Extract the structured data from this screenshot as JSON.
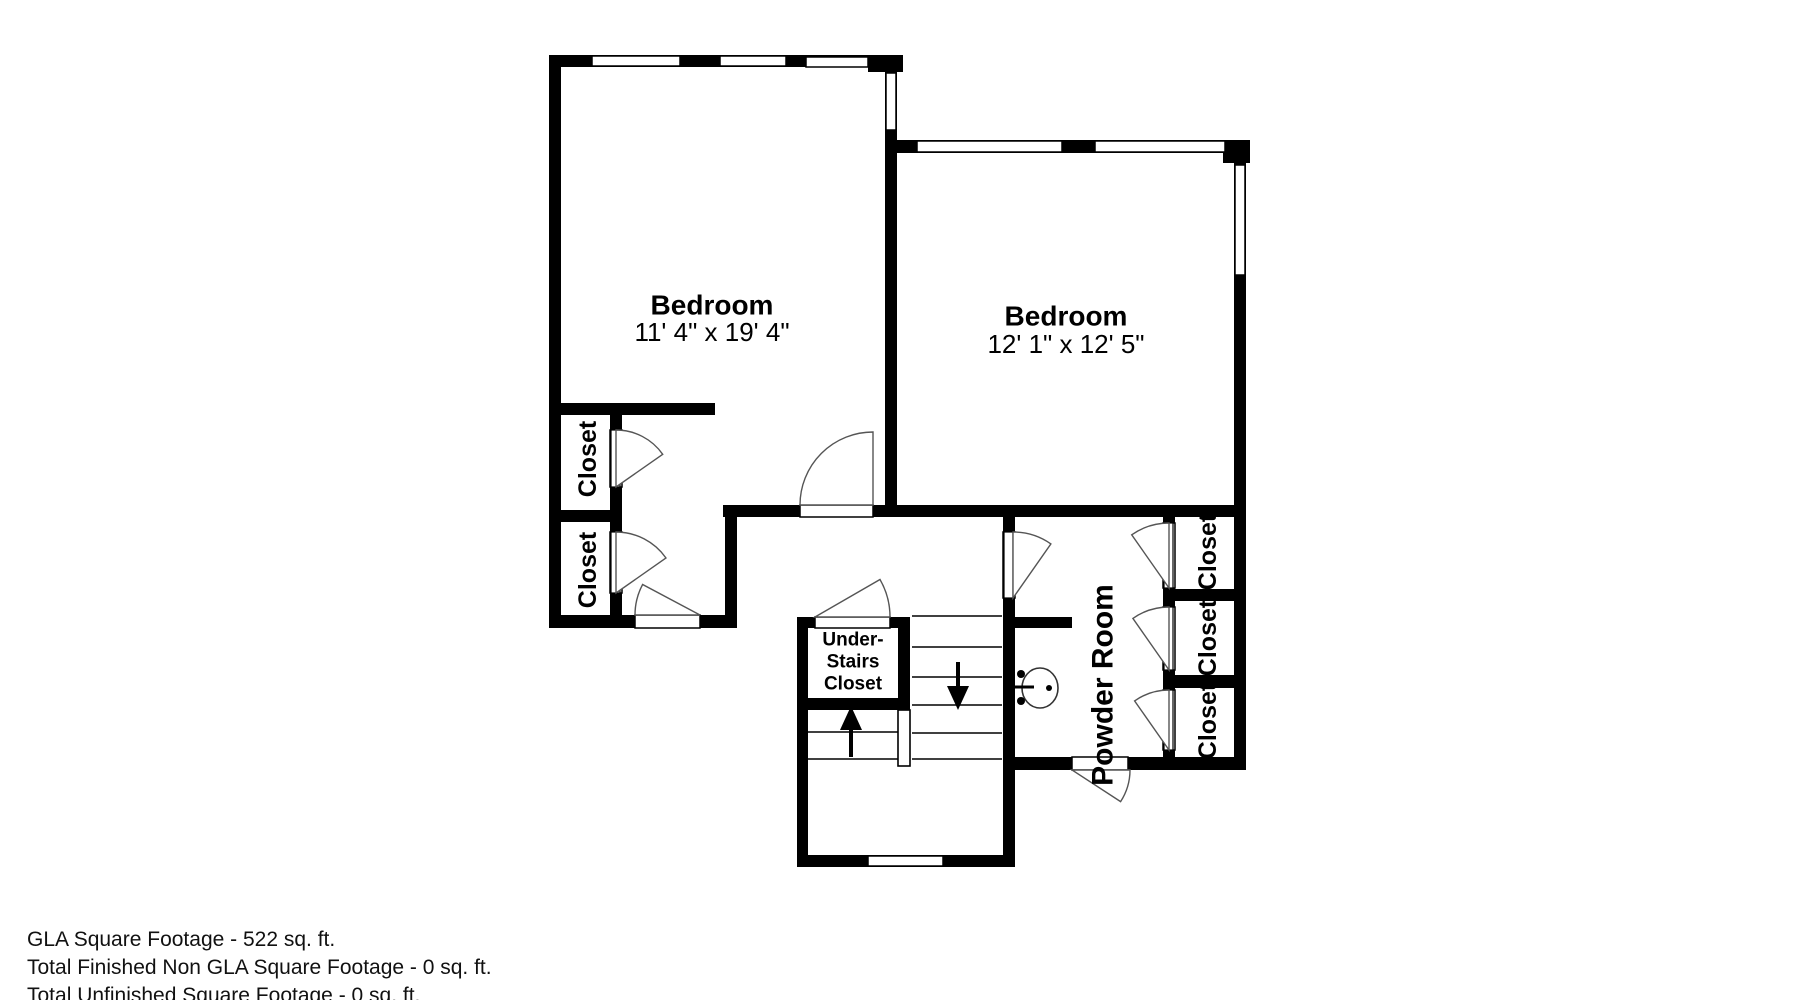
{
  "page": {
    "background": "#ffffff"
  },
  "footer": {
    "lines": [
      "GLA Square Footage - 522 sq. ft.",
      "Total Finished Non GLA Square Footage - 0 sq. ft.",
      "Total Unfinished Square Footage - 0 sq. ft."
    ]
  },
  "plan": {
    "ink": "#000000",
    "thin_stroke": "#000000",
    "arc_stroke": "#555555",
    "fixture_stroke": "#333333",
    "walls": [
      {
        "name": "wall-left-exterior",
        "rect": [
          549,
          55,
          12,
          573
        ]
      },
      {
        "name": "wall-top-left-bedroom",
        "rect": [
          549,
          55,
          354,
          12
        ]
      },
      {
        "name": "wall-top-left-corner-block",
        "rect": [
          868,
          55,
          35,
          17
        ]
      },
      {
        "name": "wall-middle-between-bedrooms",
        "rect": [
          885,
          55,
          12,
          462
        ]
      },
      {
        "name": "wall-top-right-bedroom",
        "rect": [
          897,
          140,
          353,
          13
        ]
      },
      {
        "name": "wall-top-right-corner-block",
        "rect": [
          1223,
          140,
          27,
          23
        ]
      },
      {
        "name": "wall-right-exterior",
        "rect": [
          1234,
          140,
          12,
          630
        ]
      },
      {
        "name": "wall-bottom-right",
        "rect": [
          1128,
          757,
          118,
          13
        ]
      },
      {
        "name": "wall-powder-bottom",
        "rect": [
          1003,
          757,
          69,
          13
        ]
      },
      {
        "name": "wall-hall-top",
        "rect": [
          723,
          505,
          522,
          12
        ]
      },
      {
        "name": "wall-closet-strip-top",
        "rect": [
          549,
          403,
          166,
          12
        ]
      },
      {
        "name": "wall-left-closets-right",
        "rect": [
          610,
          403,
          12,
          225
        ]
      },
      {
        "name": "wall-left-closets-divider",
        "rect": [
          549,
          510,
          73,
          12
        ]
      },
      {
        "name": "wall-bottom-left",
        "rect": [
          549,
          615,
          188,
          13
        ]
      },
      {
        "name": "wall-vestibule-right",
        "rect": [
          725,
          505,
          12,
          123
        ]
      },
      {
        "name": "wall-lower-section-left",
        "rect": [
          797,
          617,
          11,
          250
        ]
      },
      {
        "name": "wall-understairs-closet-top",
        "rect": [
          797,
          617,
          113,
          11
        ]
      },
      {
        "name": "wall-understairs-closet-bottom",
        "rect": [
          797,
          698,
          113,
          12
        ]
      },
      {
        "name": "wall-understairs-closet-right",
        "rect": [
          898,
          617,
          12,
          93
        ]
      },
      {
        "name": "wall-lower-section-bottom",
        "rect": [
          797,
          855,
          218,
          12
        ]
      },
      {
        "name": "wall-stairwell-right",
        "rect": [
          1003,
          505,
          12,
          362
        ]
      },
      {
        "name": "wall-sink-alcove",
        "rect": [
          1015,
          617,
          57,
          11
        ]
      },
      {
        "name": "wall-right-closets-left",
        "rect": [
          1163,
          517,
          12,
          253
        ]
      },
      {
        "name": "wall-right-closets-divider-a",
        "rect": [
          1163,
          589,
          83,
          12
        ]
      },
      {
        "name": "wall-right-closets-divider-b",
        "rect": [
          1163,
          675,
          83,
          13
        ]
      }
    ],
    "windows": [
      {
        "name": "window-left-bedroom-a",
        "rect": [
          592,
          56,
          88,
          10
        ]
      },
      {
        "name": "window-left-bedroom-b",
        "rect": [
          720,
          56,
          66,
          10
        ]
      },
      {
        "name": "window-left-bedroom-c",
        "rect": [
          806,
          57,
          62,
          10
        ]
      },
      {
        "name": "window-middle-wall",
        "rect": [
          886,
          73,
          10,
          57
        ]
      },
      {
        "name": "window-right-bedroom-a",
        "rect": [
          917,
          141,
          145,
          11
        ]
      },
      {
        "name": "window-right-bedroom-b",
        "rect": [
          1095,
          141,
          130,
          11
        ]
      },
      {
        "name": "window-right-wall",
        "rect": [
          1235,
          165,
          10,
          110
        ]
      },
      {
        "name": "window-stair-landing",
        "rect": [
          868,
          856,
          75,
          10
        ]
      }
    ],
    "openings": [
      {
        "name": "door-opening-hall-bedroom",
        "rect": [
          800,
          505,
          73,
          12
        ]
      },
      {
        "name": "door-opening-vestibule",
        "rect": [
          635,
          615,
          65,
          13
        ]
      },
      {
        "name": "door-opening-understairs-closet",
        "rect": [
          815,
          617,
          75,
          11
        ]
      },
      {
        "name": "door-opening-powder-exterior",
        "rect": [
          1072,
          757,
          56,
          13
        ]
      },
      {
        "name": "door-opening-hall-powder",
        "rect": [
          1003,
          532,
          12,
          66
        ]
      },
      {
        "name": "door-opening-right-closet-1",
        "rect": [
          1163,
          523,
          12,
          65
        ]
      },
      {
        "name": "door-opening-right-closet-2",
        "rect": [
          1163,
          607,
          12,
          63
        ]
      },
      {
        "name": "door-opening-right-closet-3",
        "rect": [
          1163,
          690,
          12,
          60
        ]
      },
      {
        "name": "door-opening-left-closet-1",
        "rect": [
          610,
          430,
          12,
          57
        ]
      },
      {
        "name": "door-opening-left-closet-2",
        "rect": [
          610,
          532,
          12,
          61
        ]
      }
    ],
    "leaves": [
      {
        "name": "door-leaf-hall-powder",
        "rect": [
          1004,
          532,
          9,
          66
        ]
      },
      {
        "name": "door-leaf-right-closet-1",
        "rect": [
          1164,
          523,
          9,
          65
        ]
      },
      {
        "name": "door-leaf-right-closet-2",
        "rect": [
          1164,
          607,
          9,
          63
        ]
      },
      {
        "name": "door-leaf-right-closet-3",
        "rect": [
          1164,
          690,
          9,
          60
        ]
      },
      {
        "name": "door-leaf-left-closet-1",
        "rect": [
          611,
          430,
          9,
          57
        ]
      },
      {
        "name": "door-leaf-left-closet-2",
        "rect": [
          611,
          532,
          9,
          61
        ]
      }
    ],
    "arcs": [
      {
        "name": "door-arc-hall-bedroom",
        "hinge": [
          873,
          505
        ],
        "r": 73,
        "a1": 180,
        "a2": 270
      },
      {
        "name": "door-arc-vestibule",
        "hinge": [
          700,
          615
        ],
        "r": 65,
        "a1": 180,
        "a2": 208
      },
      {
        "name": "door-arc-understairs-closet",
        "hinge": [
          815,
          617
        ],
        "r": 75,
        "a1": 330,
        "a2": 360
      },
      {
        "name": "door-arc-powder-exterior",
        "hinge": [
          1072,
          770
        ],
        "r": 58,
        "a1": 0,
        "a2": 33
      },
      {
        "name": "door-arc-hall-powder",
        "hinge": [
          1013,
          598
        ],
        "r": 66,
        "a1": 270,
        "a2": 305
      },
      {
        "name": "door-arc-right-closet-1",
        "hinge": [
          1169,
          588
        ],
        "r": 65,
        "a1": 235,
        "a2": 270
      },
      {
        "name": "door-arc-right-closet-2",
        "hinge": [
          1169,
          670
        ],
        "r": 63,
        "a1": 235,
        "a2": 270
      },
      {
        "name": "door-arc-right-closet-3",
        "hinge": [
          1169,
          750
        ],
        "r": 60,
        "a1": 235,
        "a2": 270
      },
      {
        "name": "door-arc-left-closet-1",
        "hinge": [
          616,
          487
        ],
        "r": 57,
        "a1": 270,
        "a2": 325
      },
      {
        "name": "door-arc-left-closet-2",
        "hinge": [
          616,
          593
        ],
        "r": 61,
        "a1": 270,
        "a2": 325
      }
    ],
    "treads": [
      {
        "name": "stair-nosing",
        "line": [
          912,
          616,
          1002,
          616
        ]
      },
      {
        "name": "stair-tread",
        "line": [
          912,
          647,
          1002,
          647
        ]
      },
      {
        "name": "stair-tread",
        "line": [
          912,
          677,
          1002,
          677
        ]
      },
      {
        "name": "stair-tread",
        "line": [
          912,
          705,
          1002,
          705
        ]
      },
      {
        "name": "stair-tread",
        "line": [
          912,
          733,
          1002,
          733
        ]
      },
      {
        "name": "stair-tread",
        "line": [
          912,
          759,
          1002,
          759
        ]
      },
      {
        "name": "stair-tread",
        "line": [
          808,
          732,
          898,
          732
        ]
      },
      {
        "name": "stair-tread",
        "line": [
          808,
          759,
          898,
          759
        ]
      }
    ],
    "railing": {
      "name": "stair-railing",
      "rect": [
        898,
        710,
        12,
        56
      ]
    },
    "arrows": [
      {
        "name": "stairs-up-arrow",
        "shaft": [
          851,
          757,
          851,
          728
        ],
        "head": [
          [
            851,
            706
          ],
          [
            840,
            730
          ],
          [
            862,
            730
          ]
        ]
      },
      {
        "name": "stairs-down-arrow",
        "shaft": [
          958,
          662,
          958,
          688
        ],
        "head": [
          [
            958,
            710
          ],
          [
            947,
            686
          ],
          [
            969,
            686
          ]
        ]
      }
    ],
    "sink": {
      "name": "powder-room-sink",
      "ellipse": [
        1040,
        688,
        18,
        20
      ],
      "dots": [
        [
          1021,
          674,
          4
        ],
        [
          1021,
          701,
          4
        ],
        [
          1049,
          688,
          3
        ]
      ],
      "spout": [
        1013,
        687,
        1034,
        687
      ]
    },
    "labels": [
      {
        "name": "left-bedroom-name",
        "text": "Bedroom",
        "x": 712,
        "y": 305,
        "size": 28,
        "weight": 700,
        "rotate": 0
      },
      {
        "name": "left-bedroom-dims",
        "text": "11' 4\" x 19' 4\"",
        "x": 712,
        "y": 332,
        "size": 26,
        "weight": 400,
        "rotate": 0
      },
      {
        "name": "right-bedroom-name",
        "text": "Bedroom",
        "x": 1066,
        "y": 316,
        "size": 28,
        "weight": 700,
        "rotate": 0
      },
      {
        "name": "right-bedroom-dims",
        "text": "12' 1\" x 12' 5\"",
        "x": 1066,
        "y": 344,
        "size": 26,
        "weight": 400,
        "rotate": 0
      },
      {
        "name": "left-closet-1-label",
        "text": "Closet",
        "x": 588,
        "y": 459,
        "size": 25,
        "weight": 700,
        "rotate": -90
      },
      {
        "name": "left-closet-2-label",
        "text": "Closet",
        "x": 588,
        "y": 570,
        "size": 25,
        "weight": 700,
        "rotate": -90
      },
      {
        "name": "powder-room-label",
        "text": "Powder Room",
        "x": 1103,
        "y": 685,
        "size": 30,
        "weight": 700,
        "rotate": -90
      },
      {
        "name": "right-closet-1-label",
        "text": "Closet",
        "x": 1208,
        "y": 552,
        "size": 25,
        "weight": 700,
        "rotate": -90
      },
      {
        "name": "right-closet-2-label",
        "text": "Closet",
        "x": 1208,
        "y": 638,
        "size": 25,
        "weight": 700,
        "rotate": -90
      },
      {
        "name": "right-closet-3-label",
        "text": "Closet",
        "x": 1208,
        "y": 721,
        "size": 25,
        "weight": 700,
        "rotate": -90
      },
      {
        "name": "understairs-closet-label-line1",
        "text": "Under-",
        "x": 853,
        "y": 640,
        "size": 19,
        "weight": 700,
        "rotate": 0
      },
      {
        "name": "understairs-closet-label-line2",
        "text": "Stairs",
        "x": 853,
        "y": 662,
        "size": 19,
        "weight": 700,
        "rotate": 0
      },
      {
        "name": "understairs-closet-label-line3",
        "text": "Closet",
        "x": 853,
        "y": 684,
        "size": 19,
        "weight": 700,
        "rotate": 0
      }
    ]
  }
}
